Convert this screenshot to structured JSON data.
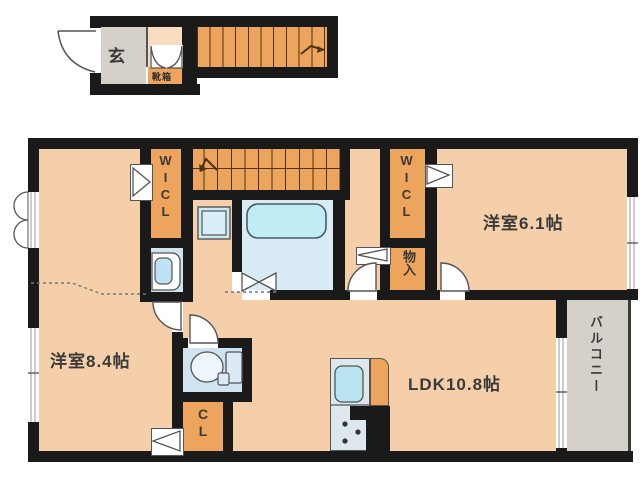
{
  "plan": {
    "labels": {
      "genkan": "玄",
      "shoebox": "靴箱",
      "wicl1": "WICL",
      "wicl2": "WICL",
      "storage": "物入",
      "room84": "洋室8.4帖",
      "room61": "洋室6.1帖",
      "ldk": "LDK10.8帖",
      "closet": "CL",
      "balcony": "バルコニー"
    },
    "icons": {
      "bathtub": "bathtub-icon",
      "toilet": "toilet-icon",
      "vanity": "sink-icon",
      "washer": "washing-machine-icon",
      "kitchen_sink": "kitchen-sink-icon",
      "stove": "stove-burners-icon",
      "stairs_up_1f": "stairs-up-arrow-icon",
      "stairs_up_2f": "stairs-up-arrow-icon"
    }
  },
  "colors": {
    "wall": "#1a1a1a",
    "floor": "#f4cfa9",
    "floorLight": "#f8dcc0",
    "accent": "#eda45c",
    "gray": "#d5d1ca",
    "bathFloor": "#d9ecf6",
    "tub": "#c0ecf6",
    "fixtureBlue": "#cde9f3",
    "toiletFloor": "#cfe4f0",
    "kitchenCounter": "#dce8ee",
    "sinkBlue": "#b9e4f0"
  }
}
